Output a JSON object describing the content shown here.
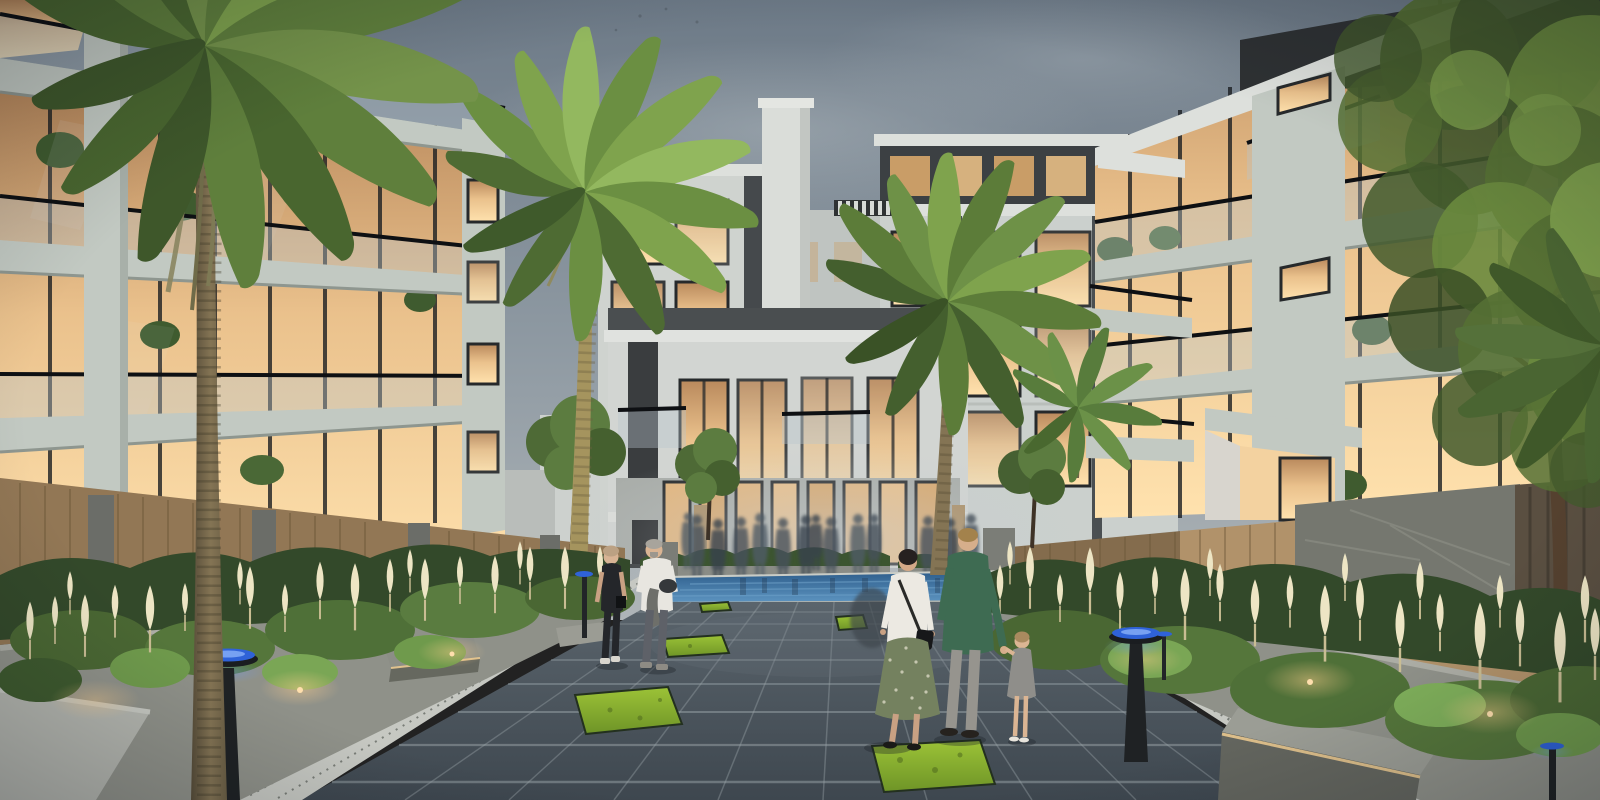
{
  "meta": {
    "title": "Residential courtyard walkway at dusk",
    "image_type": "photorealistic 3D architectural exterior rendering",
    "time_of_day": "dusk",
    "width_px": 1600,
    "height_px": 800
  },
  "scene": {
    "setting": "Landscaped pedestrian boulevard between low-rise apartment buildings, warm interior lights glowing against a blue-grey evening sky",
    "sky": "overcast blue-grey dusk sky",
    "buildings": {
      "left_block": {
        "name": "left apartment building",
        "storeys": 4,
        "facade": "glass curtain wall, sage concrete floor slabs, glass balustrade balconies, interior plants"
      },
      "right_block": {
        "name": "right apartment building",
        "storeys": 4,
        "facade": "glass and sage concrete, cantilevered balconies with glass railings, lit terrace"
      },
      "center_left_block": {
        "name": "background building A",
        "storeys": 4,
        "facade": "white render, dark accent strip, warm lit windows"
      },
      "center_right_block": {
        "name": "background building B",
        "storeys": 5,
        "facade": "white render, dark recessed top floor, dark vertical panels, roof pergola"
      },
      "center_low_block": {
        "name": "courtyard pavilion block",
        "storeys": 2,
        "facade": "double-height glazing, glass balconies, timber-framed ground colonnade"
      },
      "core_tower": {
        "name": "white core / chimney tower"
      }
    },
    "landscape": {
      "palms": [
        "large palm left foreground",
        "lit palm center-left",
        "palm center-right",
        "small palm right court",
        "palm fronds far-right edge"
      ],
      "trees": [
        "large leafy tree right edge",
        "small courtyard trees near pavilion",
        "tree beside pool"
      ],
      "planters": "raised grey stone planters with ornamental grasses and cream plume flowers",
      "fences": "timber slat fencing with stone piers and a stone feature wall"
    },
    "hardscape": {
      "walkway": "dark grey stone pavers with light grout, recessed turf squares and gravel borders",
      "turf_insets": 5,
      "water_feature": "blue reflecting pool across the far end of the walkway",
      "benches": 2,
      "lighting_fixtures": "blue-capped disc bollard lights, warm planter uplights, LED strips under benches"
    },
    "people": {
      "foreground": [
        {
          "id": "woman-dark-jumpsuit",
          "description": "blonde woman in dark sleeveless jumpsuit walking toward viewer, left side"
        },
        {
          "id": "man-white-tshirt",
          "description": "grey-haired man in white t-shirt carrying a grey jacket and dark helmet, left side"
        },
        {
          "id": "woman-white-top-green-skirt",
          "description": "dark-haired woman in white blouse and patterned green midi skirt with black shoulder bag, walking away"
        },
        {
          "id": "man-green-jacket",
          "description": "blond man in dark green blazer and grey trousers walking away, holding a toddler's hand"
        },
        {
          "id": "toddler-grey-dress",
          "description": "toddler in grey dress holding the man's hand"
        }
      ],
      "background": "blurred group of residents crossing near the pool"
    }
  },
  "palette": {
    "sky_top": "#6D7A87",
    "sky_mid": "#8E99A2",
    "sky_horizon": "#AFB5B8",
    "glow_bright": "#FFE2AE",
    "glow_warm": "#EAC18C",
    "glow_deep": "#B9895C",
    "facade_light": "#D6D9D6",
    "facade_sage": "#C2C9C2",
    "facade_shadow": "#9BA29C",
    "panel_dark": "#3F4347",
    "frame_dark": "#1C1F22",
    "rail_glass": "#B7C6CC",
    "palm_dark": "#49662F",
    "palm_mid": "#5F7F3C",
    "palm_light": "#7FA34D",
    "palm_trunk": "#847454",
    "palm_trunk_lit": "#A5945E",
    "tree_dark": "#42592C",
    "tree_mid": "#6A8A3E",
    "tree_light": "#7EA04C",
    "shrub_dark": "#33492A",
    "shrub_mid": "#4F7038",
    "shrub_light": "#6F9A4C",
    "plume": "#EDE5C4",
    "stone_planter": "#8F9189",
    "stone_cap": "#ACADA5",
    "stone_pillar": "#75776F",
    "wood_fence": "#B1926A",
    "paving_far": "#5A646C",
    "paving_near": "#3E474F",
    "grout": "#97A0A5",
    "gravel": "#C6C8C2",
    "turf_light": "#9CC337",
    "turf_dark": "#6E9427",
    "pool_deep": "#2E5E8C",
    "pool_light": "#5C93BF",
    "bollard_blue": "#2F62D8",
    "bollard_blue_light": "#6E9BF2",
    "uplight_warm": "#FFCF8C",
    "skin": "#D9B493",
    "white_shirt": "#E8E6E0",
    "jumpsuit": "#24262A",
    "green_jacket": "#3E6B52",
    "skirt_green": "#74815F",
    "trousers": "#96948E",
    "child_dress": "#8F8E8A"
  }
}
